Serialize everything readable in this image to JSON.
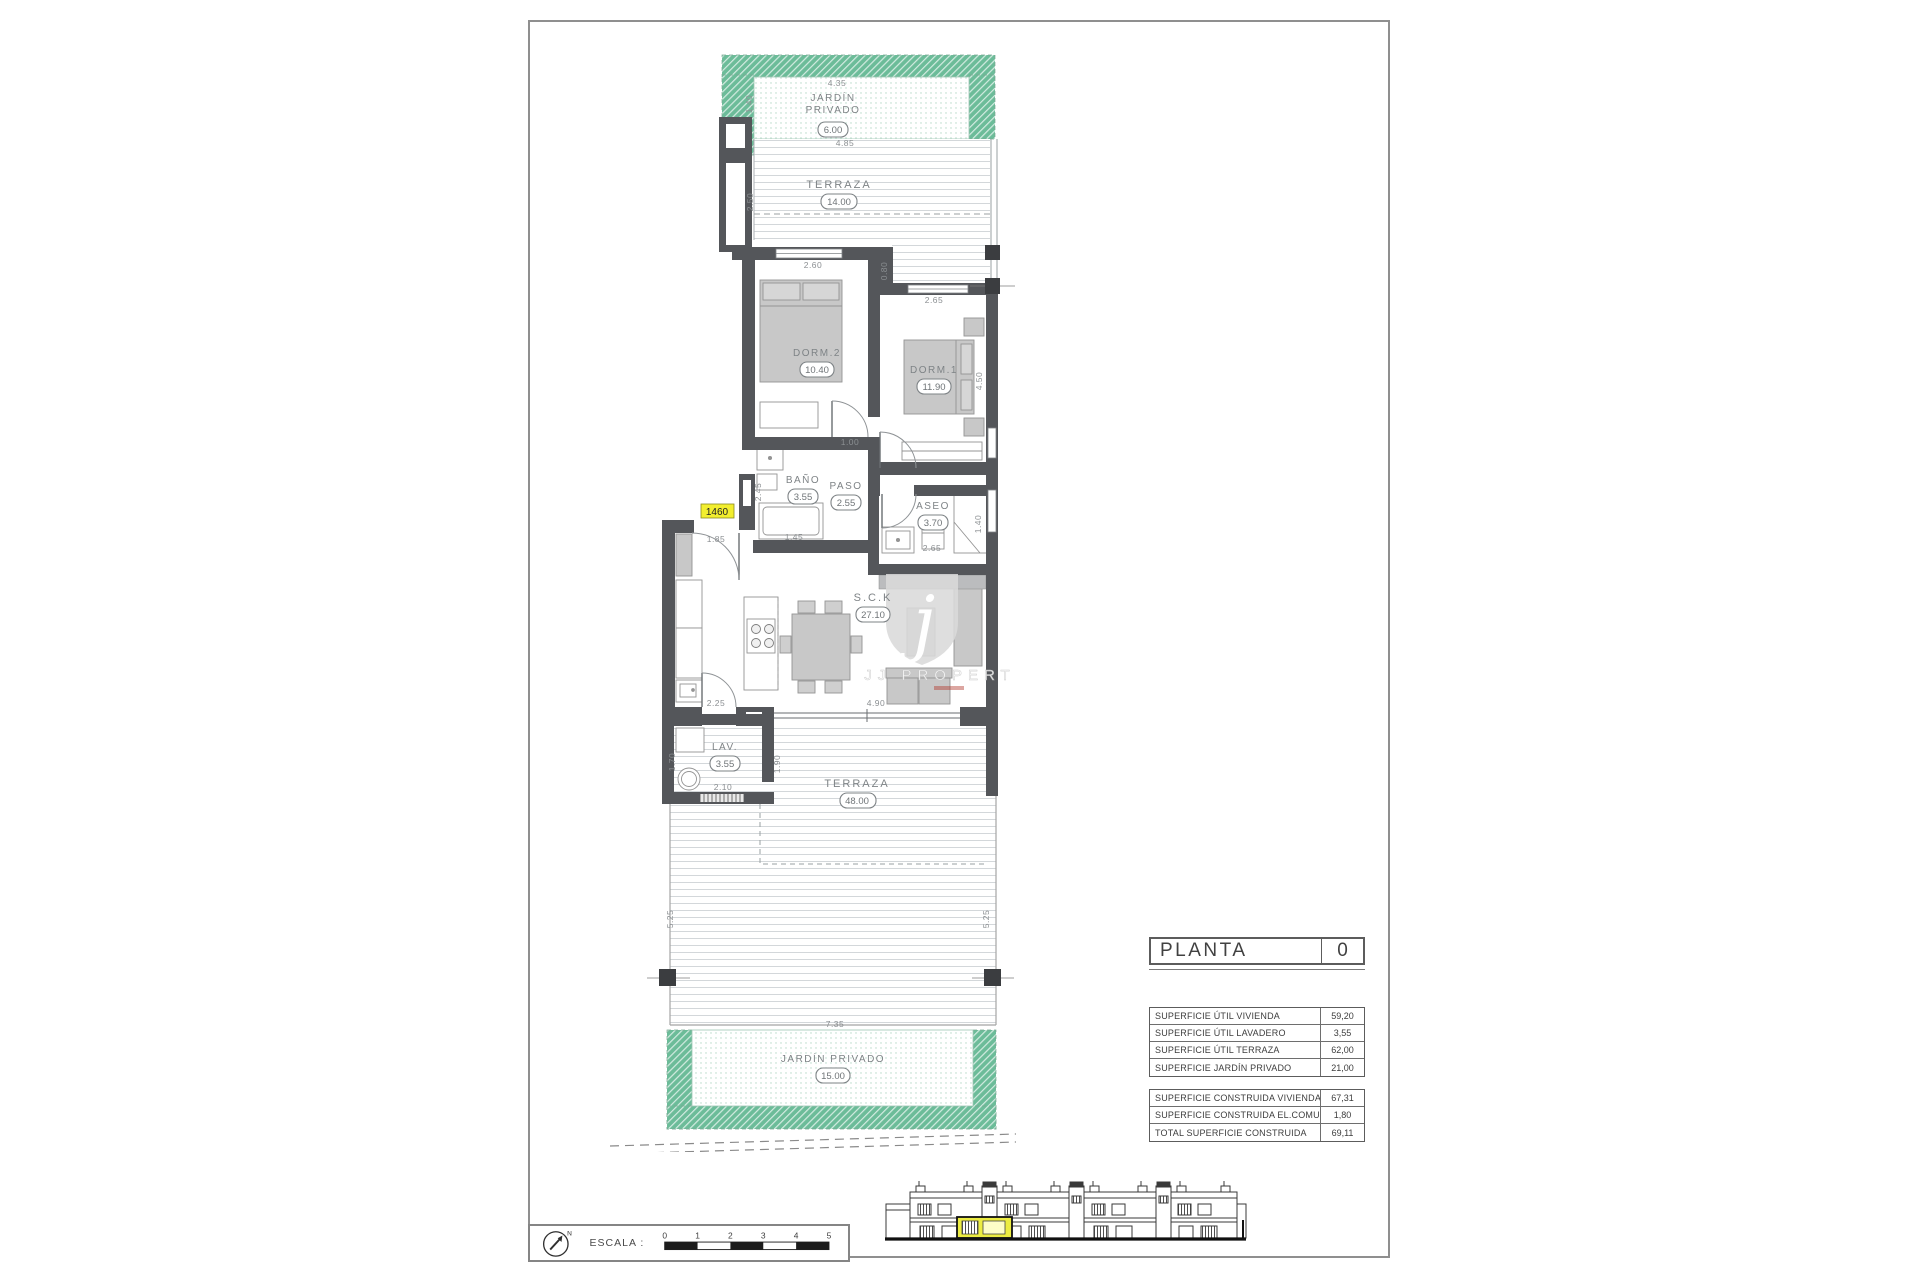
{
  "plan": {
    "unit_tag": "1460",
    "watermark": {
      "letter": "j",
      "text": "JJ PROPERT"
    },
    "rooms": {
      "jardin_top": {
        "l1": "JARDÍN",
        "l2": "PRIVADO",
        "area": "6.00"
      },
      "terraza_top": {
        "label": "TERRAZA",
        "area": "14.00"
      },
      "dorm2": {
        "label": "DORM.2",
        "area": "10.40"
      },
      "dorm1": {
        "label": "DORM.1",
        "area": "11.90"
      },
      "bano": {
        "label": "BAÑO",
        "area": "3.55"
      },
      "paso": {
        "label": "PASO",
        "area": "2.55"
      },
      "aseo": {
        "label": "ASEO",
        "area": "3.70"
      },
      "sck": {
        "label": "S.C.K",
        "area": "27.10"
      },
      "lav": {
        "label": "LAV.",
        "area": "3.55"
      },
      "terraza_bottom": {
        "label": "TERRAZA",
        "area": "48.00"
      },
      "jardin_bottom": {
        "label": "JARDÍN  PRIVADO",
        "area": "15.00"
      }
    },
    "dims": [
      "4.35",
      "1.40",
      "4.85",
      "2.50",
      "2.60",
      "0.80",
      "2.65",
      "4.50",
      "1.00",
      "2.45",
      "1.45",
      "1.85",
      "2.65",
      "1.40",
      "2.25",
      "4.90",
      "1.70",
      "2.10",
      "1.90",
      "5.25",
      "5.25",
      "7.35"
    ]
  },
  "planta_table": {
    "title": "PLANTA",
    "value": "0"
  },
  "surface_table": {
    "rows": [
      {
        "label": "SUPERFICIE ÚTIL VIVIENDA",
        "value": "59,20"
      },
      {
        "label": "SUPERFICIE ÚTIL LAVADERO",
        "value": "3,55"
      },
      {
        "label": "SUPERFICIE ÚTIL TERRAZA",
        "value": "62,00"
      },
      {
        "label": "SUPERFICIE JARDÍN PRIVADO",
        "value": "21,00"
      }
    ]
  },
  "built_table": {
    "rows": [
      {
        "label": "SUPERFICIE CONSTRUIDA VIVIENDA",
        "value": "67,31"
      },
      {
        "label": "SUPERFICIE CONSTRUIDA EL.COMUNES",
        "value": "1,80"
      },
      {
        "label": "TOTAL SUPERFICIE CONSTRUIDA",
        "value": "69,11"
      }
    ]
  },
  "scale_bar": {
    "label": "ESCALA :",
    "north": "N",
    "ticks": [
      "0",
      "1",
      "2",
      "3",
      "4",
      "5"
    ]
  }
}
